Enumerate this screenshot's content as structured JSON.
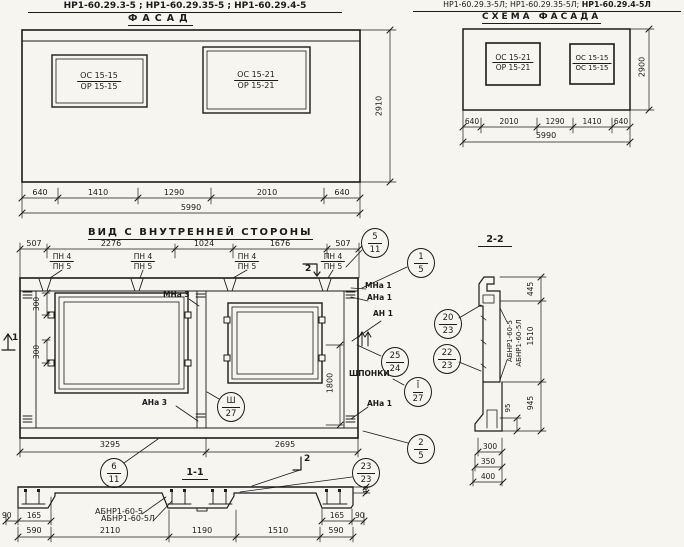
{
  "palette": {
    "ink": "#1b1b1b",
    "paper": "#f6f5f0"
  },
  "facade": {
    "title": "НР1-60.29.3-5 ; НР1-60.29.35-5 ; НР1-60.29.4-5",
    "subtitle": "ФАСАД",
    "window_left": {
      "top": "ОС 15-15",
      "bottom": "ОР 15-15"
    },
    "window_right": {
      "top": "ОС 15-21",
      "bottom": "ОР 15-21"
    },
    "dims_bottom": [
      "640",
      "1410",
      "1290",
      "2010",
      "640"
    ],
    "dim_total": "5990",
    "dim_height": "2910"
  },
  "schema": {
    "title_left": "НР1-60.29.3-5Л; НР1-60.29.35-5Л;",
    "title_right": "НР1-60.29.4-5Л",
    "subtitle": "СХЕМА ФАСАДА",
    "window_left": {
      "top": "ОС 15-21",
      "bottom": "ОР 15-21"
    },
    "window_right": {
      "top": "ОС 15-15",
      "bottom": "ОС 15-15"
    },
    "dims_bottom": [
      "640",
      "2010",
      "1290",
      "1410",
      "640"
    ],
    "dim_total": "5990",
    "dim_height": "2900"
  },
  "inner_view": {
    "title": "ВИД С ВНУТРЕННЕЙ СТОРОНЫ",
    "dims_top": [
      "507",
      "2276",
      "1024",
      "1676",
      "507"
    ],
    "loop_mark": {
      "top": "ПН 4",
      "bottom": "ПН 5"
    },
    "dim_300_upper": "300",
    "dim_300_lower": "300",
    "dim_1800": "1800",
    "dims_bottom": [
      "3295",
      "2695"
    ],
    "labels": {
      "mna3": "МНа 3",
      "ana3": "АНа 3",
      "mna1": "МНа 1",
      "ana1": "АНа 1",
      "an1": "АН 1",
      "ana1_lower": "АНа 1",
      "shponki": "ШПОНКИ"
    },
    "cut_marks": {
      "cut1": "1",
      "cut2_top": "2"
    },
    "balloons": {
      "b5_11": {
        "top": "5",
        "bottom": "11"
      },
      "b1_5": {
        "top": "1",
        "bottom": "5"
      },
      "b25_24": {
        "top": "25",
        "bottom": "24"
      },
      "bI_27": {
        "top": "Ī",
        "bottom": "27"
      },
      "bIII_27": {
        "top": "Ш",
        "bottom": "27"
      },
      "b2_5": {
        "top": "2",
        "bottom": "5"
      },
      "b6_11": {
        "top": "6",
        "bottom": "11"
      }
    }
  },
  "section_1_1": {
    "title": "1-1",
    "cut2": "2",
    "labels": {
      "abnr": "АБНР1-60-5",
      "abnr_l": "АБНР1-60-5Л"
    },
    "balloon": {
      "top": "23",
      "bottom": "23"
    },
    "dims": {
      "left_90": "90",
      "left_165": "165",
      "right_165": "165",
      "right_90": "90",
      "d40": "40",
      "bottom": [
        "590",
        "2110",
        "1190",
        "1510",
        "590"
      ]
    }
  },
  "section_2_2": {
    "title": "2-2",
    "labels": {
      "abnr": "АБНР1-60-5",
      "abnr_l": "АБНР1-60-5Л"
    },
    "balloons": {
      "b20_23": {
        "top": "20",
        "bottom": "23"
      },
      "b22_23": {
        "top": "22",
        "bottom": "23"
      }
    },
    "dims": {
      "d445": "445",
      "d1510": "1510",
      "d95": "95",
      "d945": "945",
      "d300": "300",
      "d350": "350",
      "d400": "400"
    }
  }
}
